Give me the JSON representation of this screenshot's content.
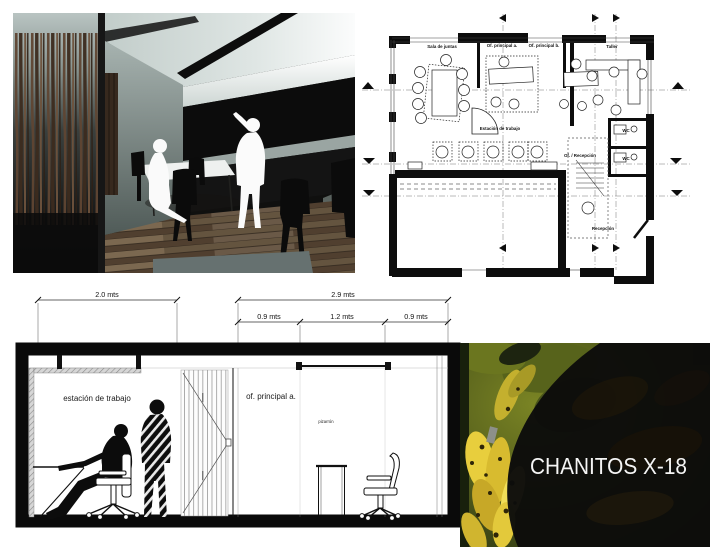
{
  "floor_plan": {
    "room_labels": [
      "Sala de juntas",
      "Of. principal a.",
      "Of. principal b.",
      "Taller",
      "Estación de trabajo",
      "Of. / Recepción",
      "WC",
      "WC",
      "Recepción"
    ]
  },
  "section": {
    "dim_top_left": "2.0 mts",
    "dim_top_right": "2.9 mts",
    "dim_sub": [
      "0.9 mts",
      "1.2 mts",
      "0.9 mts"
    ],
    "label_left_room": "estación de trabajo",
    "label_right_room": "of. principal a.",
    "label_board": "pizarrón"
  },
  "photo": {
    "title": "CHANITOS X-18"
  },
  "colors": {
    "drawing_black": "#0d0d0d",
    "banana_yellow": "#e3c93b",
    "leaf_olive": "#57631b",
    "overlay_black": "#0c0c0b",
    "render_ceiling": "#cfd8d5",
    "render_floor_wood": "#64543f"
  }
}
